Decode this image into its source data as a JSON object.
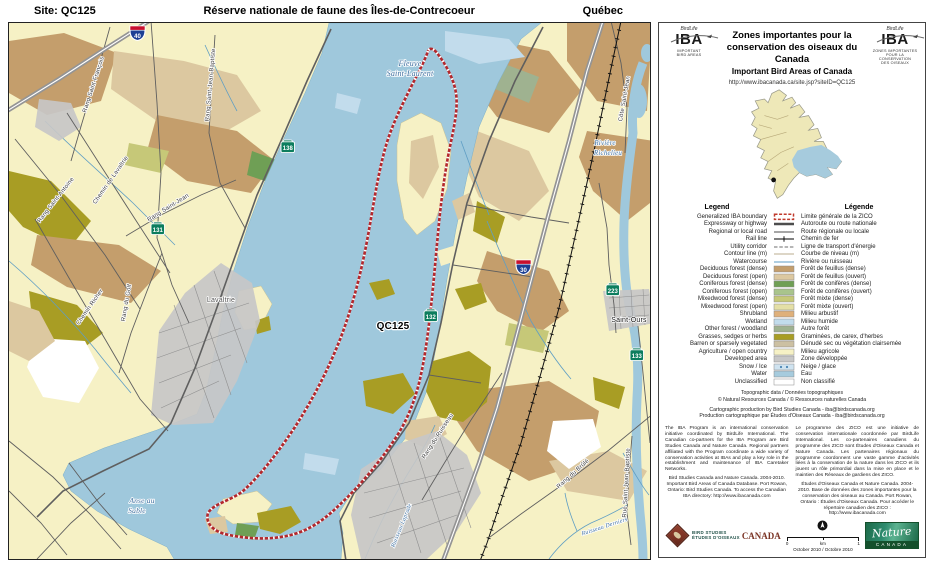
{
  "header": {
    "site": "Site: QC125",
    "title": "Réserve nationale de faune des Îles-de-Contrecoeur",
    "province": "Québec"
  },
  "panel": {
    "logo": {
      "birdlife": "BirdLife",
      "acronym": "IBA",
      "caption_left_1": "IMPORTANT",
      "caption_left_2": "BIRD AREAS",
      "caption_right_1": "ZONES IMPORTANTES",
      "caption_right_2": "POUR LA CONSERVATION",
      "caption_right_3": "DES OISEAUX"
    },
    "title": {
      "fr_line1": "Zones importantes pour la",
      "fr_line2": "conservation des oiseaux du Canada",
      "en": "Important Bird Areas of Canada"
    },
    "url": "http://www.ibacanada.ca/site.jsp?siteID=QC125",
    "legend": {
      "heading_en": "Legend",
      "heading_fr": "Légende",
      "rows": [
        {
          "en": "Generalized IBA boundary",
          "fr": "Limite générale de la ZICO",
          "type": "boundary",
          "color": "#c0392b"
        },
        {
          "en": "Expressway or highway",
          "fr": "Autoroute ou route nationale",
          "type": "road2",
          "color": "#4d4d4d"
        },
        {
          "en": "Regional or local road",
          "fr": "Route régionale ou locale",
          "type": "road1",
          "color": "#4d4d4d"
        },
        {
          "en": "Rail line",
          "fr": "Chemin de fer",
          "type": "rail",
          "color": "#000000"
        },
        {
          "en": "Utility corridor",
          "fr": "Ligne de transport d'énergie",
          "type": "utility",
          "color": "#6e6e6e"
        },
        {
          "en": "Contour line (m)",
          "fr": "Courbe de niveau (m)",
          "type": "contour",
          "color": "#a5906a"
        },
        {
          "en": "Watercourse",
          "fr": "Rivière ou ruisseau",
          "type": "stream",
          "color": "#5f9ec4"
        },
        {
          "en": "Deciduous forest (dense)",
          "fr": "Forêt de feuillus (dense)",
          "type": "fill",
          "color": "#c49e6c"
        },
        {
          "en": "Deciduous forest (open)",
          "fr": "Forêt de feuillus (ouvert)",
          "type": "fill",
          "color": "#dcc8a0"
        },
        {
          "en": "Coniferous forest (dense)",
          "fr": "Forêt de conifères (dense)",
          "type": "fill",
          "color": "#6f9f55"
        },
        {
          "en": "Coniferous forest (open)",
          "fr": "Forêt de conifères (ouvert)",
          "type": "fill",
          "color": "#a9c48c"
        },
        {
          "en": "Mixedwood forest (dense)",
          "fr": "Forêt mixte (dense)",
          "type": "fill",
          "color": "#c6c878"
        },
        {
          "en": "Mixedwood forest (open)",
          "fr": "Forêt mixte (ouvert)",
          "type": "fill",
          "color": "#e4dfa6"
        },
        {
          "en": "Shrubland",
          "fr": "Milieu arbustif",
          "type": "fill",
          "color": "#dfb07a"
        },
        {
          "en": "Wetland",
          "fr": "Milieu humide",
          "type": "fill",
          "color": "#c2dcec"
        },
        {
          "en": "Other forest / woodland",
          "fr": "Autre forêt",
          "type": "fill",
          "color": "#9fb290"
        },
        {
          "en": "Grasses, sedges or herbs",
          "fr": "Graminées, de carex, d'herbes",
          "type": "fill",
          "color": "#a89d24"
        },
        {
          "en": "Barren or sparsely vegetated",
          "fr": "Dénudé sec ou végétation clairsemée",
          "type": "fill",
          "color": "#ccc0a2"
        },
        {
          "en": "Agriculture / open country",
          "fr": "Milieu agricole",
          "type": "fill",
          "color": "#f6f1c5"
        },
        {
          "en": "Developed area",
          "fr": "Zone développée",
          "type": "fill",
          "color": "#c7c7c7"
        },
        {
          "en": "Snow / Ice",
          "fr": "Neige / glace",
          "type": "ice",
          "color": "#cfe3f0"
        },
        {
          "en": "Water",
          "fr": "Eau",
          "type": "fill",
          "color": "#a6cbdd"
        },
        {
          "en": "Unclassified",
          "fr": "Non classifié",
          "type": "fill",
          "color": "#ffffff"
        }
      ]
    },
    "credits": {
      "topo_1": "Topographic data / Données topographiques",
      "topo_2": "© Natural Resources Canada / © Ressources naturelles Canada",
      "carto_1": "Cartographic production by Bird Studies Canada - iba@birdscanada.org",
      "carto_2": "Production cartographique par Études d'Oiseaux Canada - iba@birdscanada.org"
    },
    "about": {
      "en": "The IBA Program is an international conservation initiative coordinated by BirdLife International. The Canadian co-partners for the IBA Program are Bird Studies Canada and Nature Canada. Regional partners affiliated with the Program coordinate a wide variety of conservation activities at IBAs and play a key role in the establishment and maintenance of IBA Caretaker Networks.",
      "fr": "Le programme des ZICO est une initiative de conservation internationale coordonnée par BirdLife International. Les co-partenaires canadiens du programme des ZICO sont Études d'Oiseaux Canada et Nature Canada. Les partenaires régionaux du programme coordonnent une vaste gamme d'activités liées à la conservation de la nature dans les ZICO et ils jouent un rôle primordial dans la mise en place et le maintien des Réseaux de gardiens des ZICO."
    },
    "citation": {
      "en": "Bird Studies Canada and Nature Canada. 2004-2010. Important Bird Areas of Canada Database. Port Rowan, Ontario: Bird Studies Canada. To access the Canadian IBA directory: http://www.ibacanada.com",
      "fr": "Études d'Oiseaux Canada et Nature Canada. 2004-2010. Base de données des zones importantes pour la conservation des oiseaux au Canada. Port Rowan, Ontario : Études d'Oiseaux Canada. Pour accéder le répertoire canadien des ZICO : http://www.ibacanada.com"
    },
    "footer": {
      "bsc_line1": "BIRD STUDIES",
      "bsc_line2": "ÉTUDES D'OISEAUX",
      "bsc_canada": "CANADA",
      "scale_zero": "0",
      "scale_one": "1",
      "scale_unit": "km",
      "date": "October 2010 / Octobre 2010",
      "nature_script": "Nature",
      "nature_canada": "CANADA"
    }
  },
  "map": {
    "site_code": "QC125",
    "colors": {
      "water": "#9fc8dc",
      "boundary": "#b3282d",
      "agriculture": "#f6f1c5"
    },
    "labels": [
      {
        "t": "Fleuve",
        "x": 401,
        "y": 43,
        "c": "water",
        "s": 8,
        "r": 0
      },
      {
        "t": "Saint-Laurent",
        "x": 401,
        "y": 53,
        "c": "water",
        "s": 8,
        "r": 0
      },
      {
        "t": "QC125",
        "x": 384,
        "y": 306,
        "c": "site",
        "s": 10,
        "r": 0
      },
      {
        "t": "Lavaltrie",
        "x": 212,
        "y": 279,
        "c": "town2",
        "s": 7,
        "r": 0
      },
      {
        "t": "Saint-Ours",
        "x": 620,
        "y": 299,
        "c": "town",
        "s": 7,
        "r": 0
      },
      {
        "t": "Anse au",
        "x": 133,
        "y": 480,
        "c": "water",
        "s": 7.5,
        "r": 0
      },
      {
        "t": "Sable",
        "x": 128,
        "y": 490,
        "c": "water",
        "s": 7.5,
        "r": 0
      },
      {
        "t": "Rivière",
        "x": 596,
        "y": 122,
        "c": "water",
        "s": 7,
        "r": 0
      },
      {
        "t": "Richelieu",
        "x": 599,
        "y": 132,
        "c": "water",
        "s": 7,
        "r": 0
      },
      {
        "t": "Rang Saint-François",
        "x": 86,
        "y": 62,
        "c": "road",
        "s": 6,
        "r": -72
      },
      {
        "t": "Rang Saint-Jean-Baptiste",
        "x": 203,
        "y": 62,
        "c": "road",
        "s": 6,
        "r": -85
      },
      {
        "t": "Rang Saint-Antoine",
        "x": 48,
        "y": 178,
        "c": "road",
        "s": 6,
        "r": -52
      },
      {
        "t": "Chemin de Lavaltrie",
        "x": 103,
        "y": 158,
        "c": "road",
        "s": 6,
        "r": -55
      },
      {
        "t": "Chemin Richer",
        "x": 82,
        "y": 285,
        "c": "road",
        "s": 6,
        "r": -55
      },
      {
        "t": "Rang Saint-Jean",
        "x": 160,
        "y": 186,
        "c": "road",
        "s": 6,
        "r": -32
      },
      {
        "t": "Rang du Golf",
        "x": 119,
        "y": 280,
        "c": "road",
        "s": 6,
        "r": -80
      },
      {
        "t": "Côte Saint-Jean",
        "x": 617,
        "y": 76,
        "c": "road",
        "s": 6,
        "r": -80
      },
      {
        "t": "Rang du Brûlé",
        "x": 565,
        "y": 452,
        "c": "road",
        "s": 6,
        "r": -42
      },
      {
        "t": "Rue Saint-Jean-Baptiste",
        "x": 619,
        "y": 460,
        "c": "road",
        "s": 6,
        "r": -87
      },
      {
        "t": "Rang du Ruisseau",
        "x": 430,
        "y": 414,
        "c": "road",
        "s": 6,
        "r": -57
      },
      {
        "t": "Ruisseau Laprade",
        "x": 394,
        "y": 503,
        "c": "stream",
        "s": 6,
        "r": -68
      },
      {
        "t": "Ruisseau Derniers",
        "x": 596,
        "y": 505,
        "c": "stream",
        "s": 6,
        "r": -18
      }
    ],
    "shields": [
      {
        "n": "40",
        "t": "a",
        "x": 121,
        "y": 3
      },
      {
        "n": "30",
        "t": "a",
        "x": 507,
        "y": 237
      },
      {
        "n": "138",
        "t": "p",
        "x": 272,
        "y": 118
      },
      {
        "n": "131",
        "t": "p",
        "x": 142,
        "y": 200
      },
      {
        "n": "132",
        "t": "p",
        "x": 415,
        "y": 287
      },
      {
        "n": "223",
        "t": "p",
        "x": 597,
        "y": 261
      },
      {
        "n": "133",
        "t": "p",
        "x": 621,
        "y": 326
      }
    ]
  }
}
